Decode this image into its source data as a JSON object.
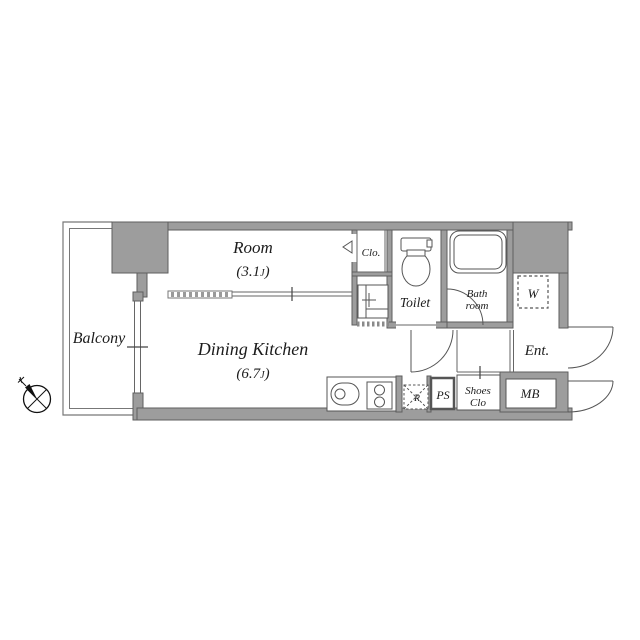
{
  "plan": {
    "rooms": {
      "balcony": {
        "label": "Balcony"
      },
      "room": {
        "label": "Room",
        "size_open": "(3.1",
        "size_unit": "J",
        "size_close": ")"
      },
      "dining_kitchen": {
        "label": "Dining Kitchen",
        "size_open": "(6.7",
        "size_unit": "J",
        "size_close": ")"
      },
      "closet": {
        "label": "Clo."
      },
      "toilet": {
        "label": "Toilet"
      },
      "bathroom": {
        "label_line1": "Bath",
        "label_line2": "room"
      },
      "washer_space": {
        "label": "W"
      },
      "entrance": {
        "label": "Ent."
      },
      "shoes_closet": {
        "label_line1": "Shoes",
        "label_line2": "Clo"
      },
      "pipe_space": {
        "label": "PS"
      },
      "refrigerator_space": {
        "label": "R"
      },
      "meter_box": {
        "label": "MB"
      }
    },
    "colors": {
      "wall_fill": "#9d9d9d",
      "wall_stroke": "#5e5e5e",
      "line": "#555555",
      "background": "#ffffff",
      "compass": "#111111"
    }
  }
}
